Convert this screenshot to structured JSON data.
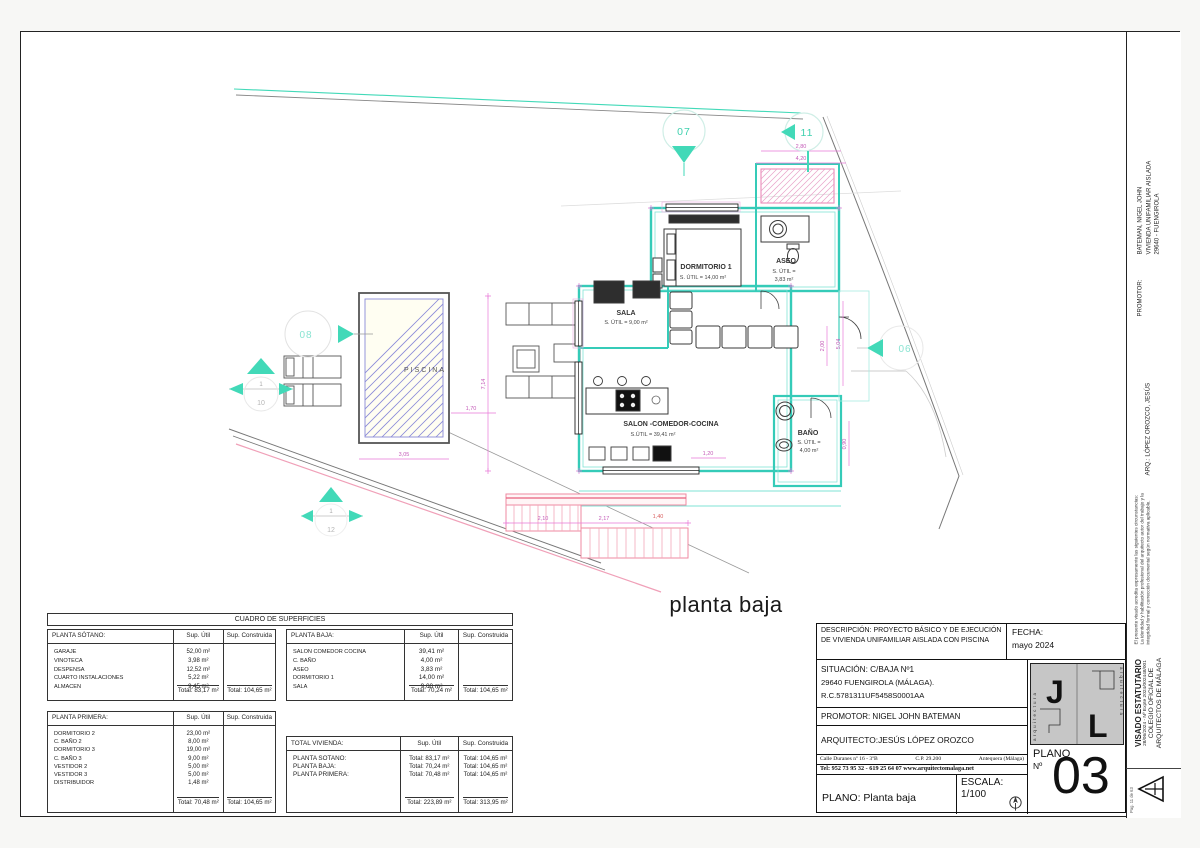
{
  "plan": {
    "caption": "planta baja",
    "rooms": [
      {
        "name": "PISCINA",
        "detail": ""
      },
      {
        "name": "DORMITORIO 1",
        "detail": "S. ÚTIL = 14,00 m²"
      },
      {
        "name": "ASEO",
        "detail": "S. ÚTIL =",
        "detail2": "3,83 m²"
      },
      {
        "name": "SALA",
        "detail": "S. ÚTIL = 9,00 m²"
      },
      {
        "name": "SALON -COMEDOR-COCINA",
        "detail": "S.ÚTIL = 39,41 m²"
      },
      {
        "name": "BAÑO",
        "detail": "S. ÚTIL =",
        "detail2": "4,00 m²"
      }
    ],
    "markers": [
      {
        "label": "07"
      },
      {
        "label": "11"
      },
      {
        "label": "08"
      },
      {
        "label": "06"
      },
      {
        "label": "1",
        "sub": "10"
      },
      {
        "label": "1",
        "sub": "12"
      }
    ],
    "dims": [
      "2,80",
      "4,20",
      "7,14",
      "5,04",
      "2,00",
      "1,20",
      "0,90",
      "2,10",
      "2,17",
      "1,40",
      "3,05",
      "1,70"
    ],
    "colors": {
      "wall_teal": "#35cbb8",
      "dimension_magenta": "#e878d8",
      "stair_pink": "#ef8aa2",
      "pool_hatch_blue": "#8a8ad8",
      "marker_teal": "#3ed0ae"
    }
  },
  "tables": {
    "title": "CUADRO DE SUPERFICIES",
    "col_util": "Sup. Útil",
    "col_construida": "Sup. Construida",
    "sotano": {
      "header": "PLANTA SÓTANO:",
      "rows": [
        [
          "GARAJE",
          "52,00 m²"
        ],
        [
          "VINOTECA",
          "3,98 m²"
        ],
        [
          "DESPENSA",
          "12,52 m²"
        ],
        [
          "CUARTO INSTALACIONES",
          "5,22 m²"
        ],
        [
          "ALMACEN",
          "9,45 m²"
        ]
      ],
      "total_util": "Total: 83,17 m²",
      "total_construida": "Total: 104,65 m²"
    },
    "baja": {
      "header": "PLANTA BAJA:",
      "rows": [
        [
          "SALON COMEDOR COCINA",
          "39,41 m²"
        ],
        [
          "C. BAÑO",
          "4,00 m²"
        ],
        [
          "ASEO",
          "3,83 m²"
        ],
        [
          "DORMITORIO 1",
          "14,00 m²"
        ],
        [
          "SALA",
          "9,00 m²"
        ]
      ],
      "total_util": "Total: 70,24 m²",
      "total_construida": "Total: 104,65 m²"
    },
    "primera": {
      "header": "PLANTA PRIMERA:",
      "rows": [
        [
          "DORMITORIO 2",
          "23,00 m²"
        ],
        [
          "C. BAÑO 2",
          "8,00 m²"
        ],
        [
          "DORMITORIO 3",
          "19,00 m²"
        ],
        [
          "C. BAÑO 3",
          "9,00 m²"
        ],
        [
          "VESTIDOR 2",
          "5,00 m²"
        ],
        [
          "VESTIDOR 3",
          "5,00 m²"
        ],
        [
          "DISTRIBUIDOR",
          "1,48 m²"
        ]
      ],
      "total_util": "Total: 70,48 m²",
      "total_construida": "Total: 104,65 m²"
    },
    "total": {
      "header": "TOTAL VIVIENDA:",
      "rows": [
        [
          "PLANTA SOTANO:",
          "Total: 83,17 m²",
          "Total: 104,65 m²"
        ],
        [
          "PLANTA BAJA:",
          "Total: 70,24 m²",
          "Total: 104,65 m²"
        ],
        [
          "PLANTA PRIMERA:",
          "Total: 70,48 m²",
          "Total: 104,65 m²"
        ]
      ],
      "total_util": "Total: 223,89 m²",
      "total_construida": "Total:  313,95 m²"
    }
  },
  "title_block": {
    "descripcion": "DESCRIPCIÓN: PROYECTO BÁSICO Y DE EJECUCIÓN DE VIVIENDA UNIFAMILIAR AISLADA CON PISCINA",
    "fecha_label": "FECHA:",
    "fecha": "mayo  2024",
    "situacion_line1": "SITUACIÓN:  C/BAJA Nº1",
    "situacion_line2": "29640 FUENGIROLA (MÁLAGA).",
    "situacion_line3": "R.C.5781311UF5458S0001AA",
    "promotor": "PROMOTOR: NIGEL JOHN BATEMAN",
    "arquitecto": "ARQUITECTO:JESÚS LÓPEZ OROZCO",
    "address_a": "Calle Duranes nº 16 - 3ºB",
    "address_b": "C.P. 29.200",
    "address_c": "Antequera (Málaga)",
    "address_line2": "Tel: 952 73 95 32 - 619 25 64 07 www.arquitectomalaga.net",
    "plano_label": "PLANO: Planta baja",
    "escala_label": "ESCALA:",
    "escala_value": "1/100",
    "plano_no_line1": "PLANO",
    "plano_no_line2": "Nº",
    "plano_number": "03",
    "logo_j": "J",
    "logo_l": "L",
    "logo_vertical": "arquitectura"
  },
  "side_strip": {
    "promotor_label": "PROMOTOR:",
    "promotor_line1": "BATEMAN, NIGEL JOHN",
    "promotor_line2": "VIVIENDA UNIFAMILIAR AISLADA",
    "promotor_line3": "29640 - FUENGIROLA",
    "arq_line": "ARQ.: LÓPEZ OROZCO, JESÚS",
    "visado_title": "VISADO ESTATUTARIO",
    "visado_expte": "28/06/2024 - Nº Expte 2024/002448/001",
    "visado_org1": "COLEGIO OFICIAL DE",
    "visado_org2": "ARQUITECTOS DE MÁLAGA",
    "visado_note": "El presente visado acredita expresamente las siguientes circunstancias: La identidad y habilitación profesional del arquitecto autor del trabajo y la integridad formal y corrección documental según normativa aplicable.",
    "page_note": "Pag. 11 de 63"
  }
}
